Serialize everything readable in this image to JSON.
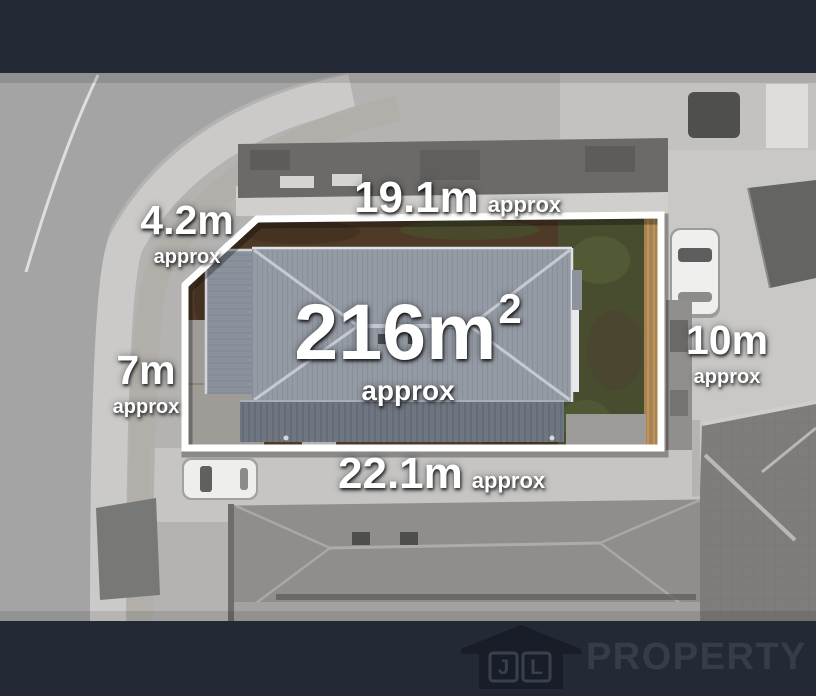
{
  "scene": {
    "description_visible_elements": "aerial photo of property lot with white boundary and dimension overlays",
    "colors": {
      "banner": "#242a35",
      "lot_border": "#ffffff",
      "dirt": "#4e3a27",
      "grass": "#474d2e",
      "subject_roof": "#959ba4",
      "fence": "#a8824f",
      "label_text": "#ffffff",
      "logo_icon": "#181d27",
      "logo_text": "#363d4a"
    }
  },
  "dimensions": {
    "top": {
      "value": "19.1m",
      "qualifier": "approx"
    },
    "top_left": {
      "value": "4.2m",
      "qualifier": "approx"
    },
    "left": {
      "value": "7m",
      "qualifier": "approx"
    },
    "right": {
      "value": "10m",
      "qualifier": "approx"
    },
    "bottom": {
      "value": "22.1m",
      "qualifier": "approx"
    },
    "area": {
      "value": "216m",
      "superscript": "2",
      "qualifier": "approx"
    }
  },
  "logo": {
    "initial_left": "J",
    "initial_right": "L",
    "wordmark": "PROPERTY"
  }
}
